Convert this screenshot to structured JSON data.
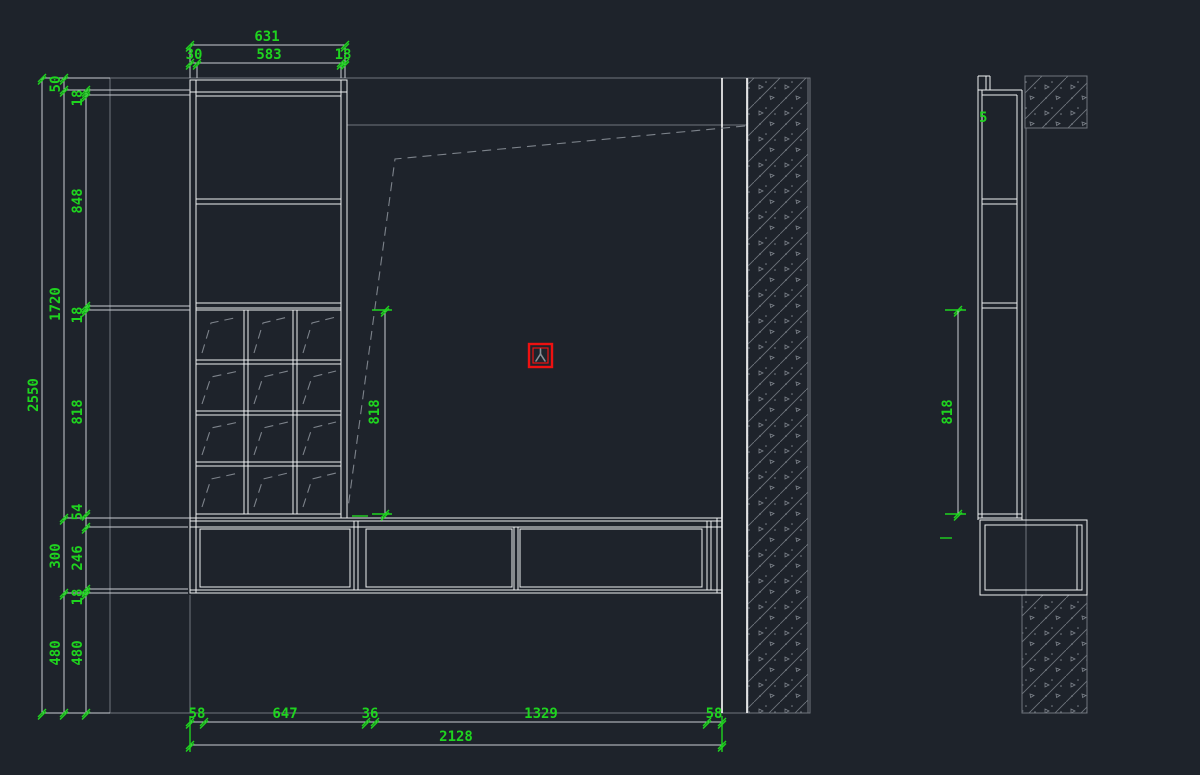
{
  "drawing": {
    "type": "cad-elevation",
    "colors": {
      "background": "#1e232b",
      "geometry": "#eef0f2",
      "wall": "#70767e",
      "dimension_text": "#1fd41f",
      "selection": "#ee1111"
    }
  },
  "dimensions": {
    "top": {
      "total": "631",
      "segments": [
        "30",
        "583",
        "18"
      ]
    },
    "left_outer_total": "2550",
    "left_middle_chain": [
      "50",
      "1720",
      "300",
      "480"
    ],
    "left_inner_chain": [
      "18",
      "848",
      "18",
      "818",
      "54",
      "246",
      "18",
      "480"
    ],
    "middle_vertical": "818",
    "bottom": {
      "segments": [
        "58",
        "647",
        "36",
        "1329",
        "58"
      ],
      "total": "2128"
    },
    "side_view_vertical": "818",
    "side_view_note": "5"
  }
}
